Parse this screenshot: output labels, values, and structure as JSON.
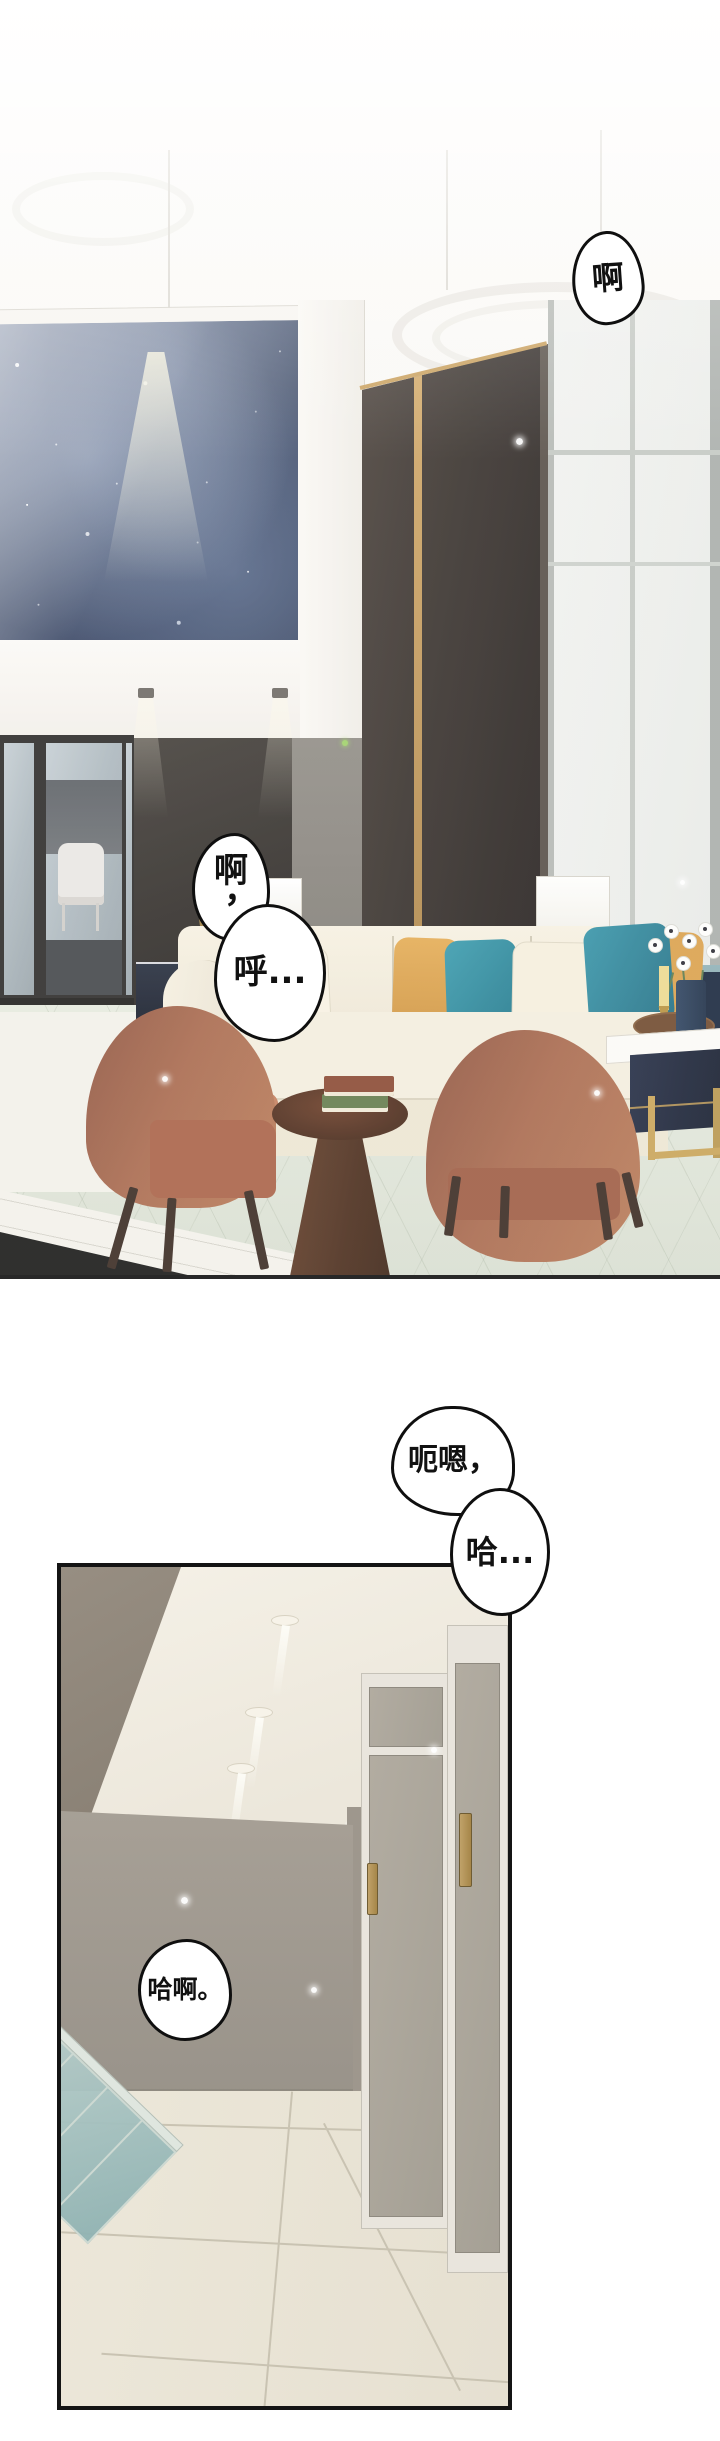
{
  "page": {
    "width": 720,
    "height": 2441,
    "background": "#ffffff"
  },
  "panels": {
    "panel1": {
      "name": "living-room-scene"
    },
    "panel2": {
      "name": "hallway-scene"
    }
  },
  "bubbles": {
    "b1": {
      "text": "啊"
    },
    "b2a": {
      "char": "啊",
      "punct": "，"
    },
    "b2b": {
      "text": "呼..."
    },
    "b3": {
      "text": "呃嗯，"
    },
    "b4": {
      "text": "哈..."
    },
    "b5": {
      "text": "哈啊。"
    }
  },
  "colors": {
    "outline": "#0f0f0f",
    "bubble_fill": "#ffffff",
    "night_artwork": "#44516d",
    "dark_wall": "#322e2a",
    "gold_trim": "#c9a05e",
    "sofa_cream": "#f3edde",
    "pillow_teal": "#2d8a9f",
    "pillow_mustard": "#dfa64f",
    "chair_terracotta": "#a96a4e",
    "coffee_table_navy": "#1d2438",
    "pedestal_wood": "#53301f",
    "hall_wall_taupe": "#a39c93",
    "hall_floor_beige": "#ebe6d8",
    "railing_glass_teal": "#a4bfc0"
  }
}
